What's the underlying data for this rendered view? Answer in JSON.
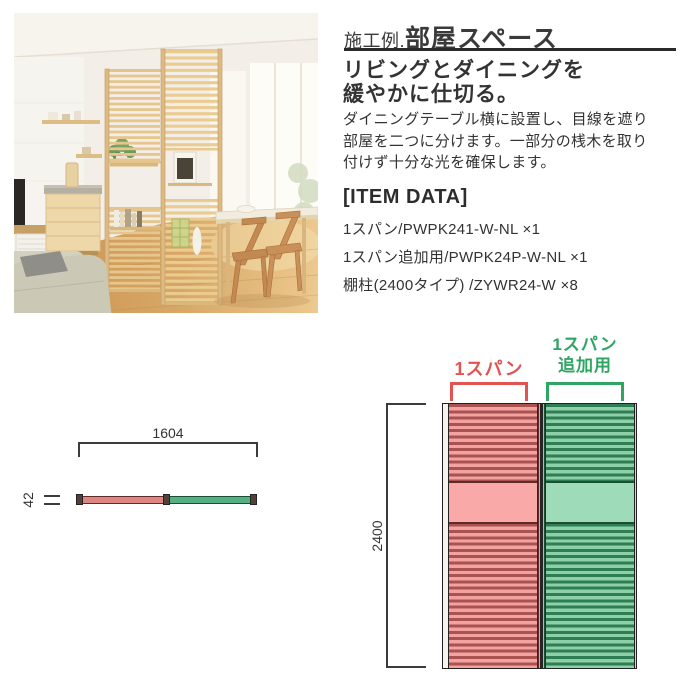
{
  "colors": {
    "text": "#333333",
    "rule": "#2a2a2a",
    "accent_red": "#e25450",
    "accent_green": "#2fa463",
    "panel_red_light": "#f2a3a1",
    "panel_red_dark": "#a9524f",
    "panel_green_light": "#8ed0aa",
    "panel_green_dark": "#2e7d53"
  },
  "header": {
    "title_prefix": "施工例.",
    "title": "部屋スペース"
  },
  "subtitle": {
    "line1": "リビングとダイニングを",
    "line2": "緩やかに仕切る。"
  },
  "description": {
    "lines": [
      "ダイニングテーブル横に設置し、目線を遮り",
      "部屋を二つに分けます。一部分の桟木を取り",
      "付けず十分な光を確保します。"
    ]
  },
  "item_data": {
    "heading": "[ITEM DATA]",
    "items": [
      "1スパン/PWPK241-W-NL ×1",
      "1スパン追加用/PWPK24P-W-NL ×1",
      "棚柱(2400タイプ) /ZYWR24-W ×8"
    ]
  },
  "plan_view": {
    "width_label": "1604",
    "depth_label": "42"
  },
  "front_view": {
    "height_label": "2400",
    "span1_label": "1スパン",
    "span2_label_line1": "1スパン",
    "span2_label_line2": "追加用"
  }
}
